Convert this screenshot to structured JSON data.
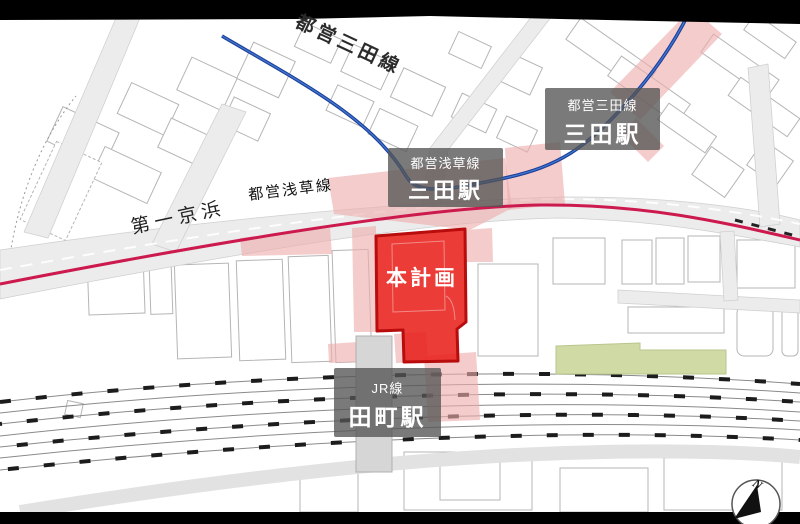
{
  "colors": {
    "plan_red": "#e8211c",
    "plan_border": "#b90c0c",
    "pink": "#eeadad",
    "line_blue": "#1d3f9a",
    "line_blue_light": "#4077cf",
    "line_magenta": "#cc1a4e",
    "green": "#cfdaa5",
    "label_box": "rgba(85,85,85,0.78)",
    "road_gray": "#ececec"
  },
  "labels": {
    "toei_mita_top": "都営三田線",
    "daiichi_keihin": "第一京浜",
    "toei_asakusa_road": "都営浅草線"
  },
  "stations": {
    "mita_mita_line": {
      "line": "都営三田線",
      "name": "三田駅"
    },
    "mita_asakusa_line": {
      "line": "都営浅草線",
      "name": "三田駅"
    },
    "tamachi": {
      "line": "JR線",
      "name": "田町駅"
    }
  },
  "plan": {
    "label": "本計画"
  },
  "compass": {
    "north": "N"
  }
}
